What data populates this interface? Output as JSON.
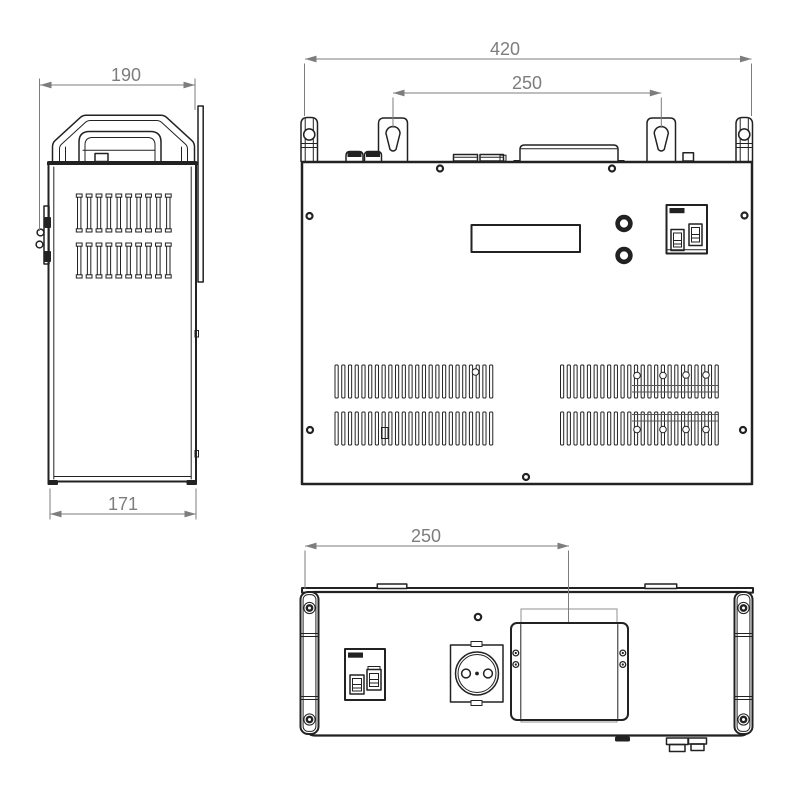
{
  "drawing": {
    "dims": {
      "side_width": "190",
      "side_depth": "171",
      "front_width": "420",
      "front_keyhole_spacing": "250",
      "bottom_terminal_offset": "250"
    },
    "colors": {
      "background": "#ffffff",
      "line": "#222222",
      "dimension": "#7d7d7d"
    }
  }
}
